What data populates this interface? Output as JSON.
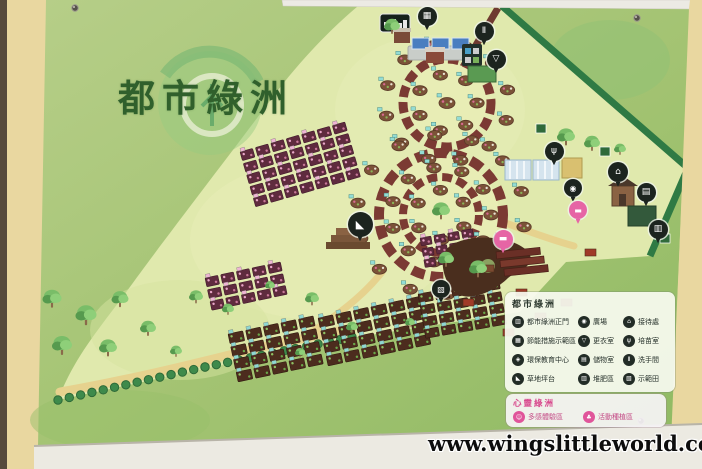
{
  "photo": {
    "watermark": "www.wingslittleworld.com"
  },
  "board": {
    "title": "都市綠洲",
    "legend": {
      "main": {
        "title": "都市綠洲",
        "items": [
          {
            "name": "main-gate",
            "glyph": "▥",
            "label": "都市綠洲正門"
          },
          {
            "name": "energy-demo-area",
            "glyph": "▦",
            "label": "節能措施示範區"
          },
          {
            "name": "eco-education-center",
            "glyph": "◈",
            "label": "環保教育中心"
          },
          {
            "name": "lawn-platform",
            "glyph": "◣",
            "label": "草地坪台"
          },
          {
            "name": "plaza",
            "glyph": "◉",
            "label": "廣場"
          },
          {
            "name": "changing-room",
            "glyph": "▽",
            "label": "更衣室"
          },
          {
            "name": "storage-room",
            "glyph": "▤",
            "label": "儲物室"
          },
          {
            "name": "compost-area",
            "glyph": "▥",
            "label": "堆肥區"
          },
          {
            "name": "reception",
            "glyph": "⌂",
            "label": "接待處"
          },
          {
            "name": "nursery-room",
            "glyph": "ψ",
            "label": "培苗室"
          },
          {
            "name": "restroom",
            "glyph": "Ⅱ",
            "label": "洗手間"
          },
          {
            "name": "demo-field",
            "glyph": "▧",
            "label": "示範田"
          }
        ]
      },
      "mind": {
        "title": "心靈綠洲",
        "items": [
          {
            "name": "multi-sensory-area",
            "glyph": "☺",
            "label": "多感體驗區"
          },
          {
            "name": "activity-planting-area",
            "glyph": "♣",
            "label": "活動種植區"
          }
        ]
      }
    },
    "map_markers": [
      {
        "name": "solar-panel-pin",
        "glyph": "▦",
        "x": 427,
        "y": 16,
        "kind": "dark",
        "s": 19
      },
      {
        "name": "restroom-pin",
        "glyph": "Ⅱ",
        "x": 484,
        "y": 31,
        "kind": "dark",
        "s": 19
      },
      {
        "name": "changing-room-pin",
        "glyph": "▽",
        "x": 496,
        "y": 59,
        "kind": "dark",
        "s": 19
      },
      {
        "name": "lawn-platform-pin",
        "glyph": "◣",
        "x": 360,
        "y": 224,
        "kind": "dark",
        "s": 25
      },
      {
        "name": "nursery-pin",
        "glyph": "ψ",
        "x": 554,
        "y": 151,
        "kind": "dark",
        "s": 19
      },
      {
        "name": "reception-pin",
        "glyph": "⌂",
        "x": 618,
        "y": 172,
        "kind": "dark",
        "s": 20
      },
      {
        "name": "storage-pin",
        "glyph": "▤",
        "x": 646,
        "y": 192,
        "kind": "dark",
        "s": 19
      },
      {
        "name": "compost-pin",
        "glyph": "▥",
        "x": 658,
        "y": 229,
        "kind": "dark",
        "s": 19
      },
      {
        "name": "demo-field-pin",
        "glyph": "▧",
        "x": 441,
        "y": 289,
        "kind": "dark",
        "s": 18
      },
      {
        "name": "plaza-pin",
        "glyph": "◉",
        "x": 573,
        "y": 188,
        "kind": "dark",
        "s": 18
      },
      {
        "name": "sensory-pin",
        "glyph": "▬",
        "x": 503,
        "y": 239,
        "kind": "pink",
        "s": 19
      },
      {
        "name": "planting-pin",
        "glyph": "▬",
        "x": 578,
        "y": 210,
        "kind": "pink",
        "s": 18
      }
    ],
    "colors": {
      "board_green": "#a3c372",
      "map_area": "#e0e9ad",
      "hedge": "#2f7a44",
      "ring_brick": "#7b3a33",
      "legend_ink": "#222c26",
      "accent_pink": "#e0559a",
      "title_green": "#30602c",
      "wall_tan": "#e9d7a0",
      "frame_white": "#eceae4"
    }
  }
}
